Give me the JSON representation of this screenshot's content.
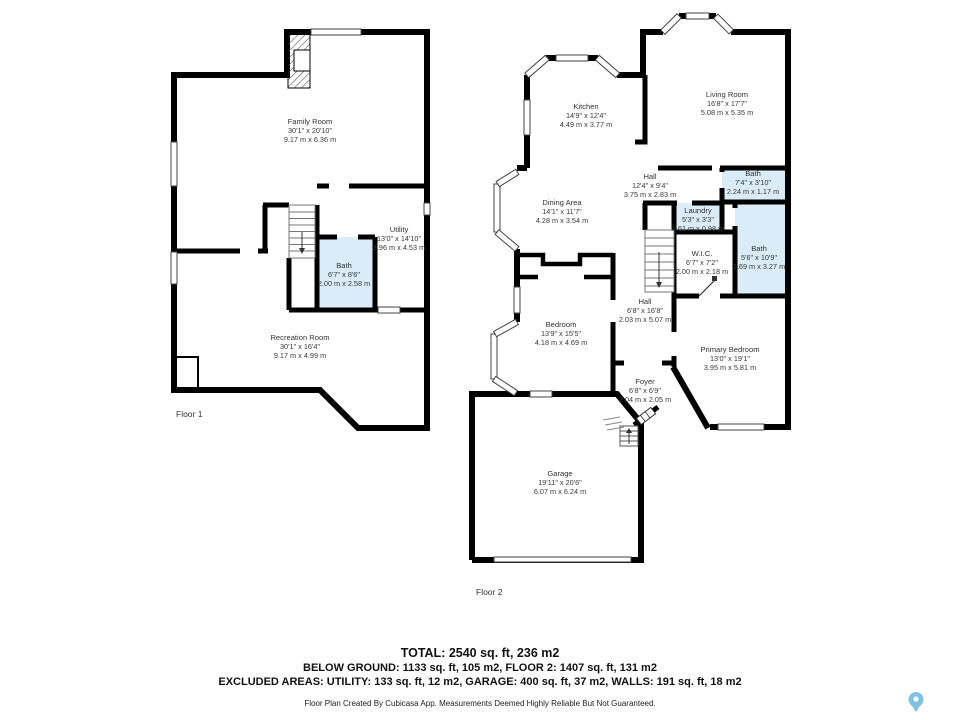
{
  "colors": {
    "wall": "#000000",
    "bath_fill": "#d9ecf8",
    "text": "#333333",
    "pin": "#7fc2e6"
  },
  "floor1": {
    "label": "Floor 1",
    "rooms": [
      {
        "name": "Family Room",
        "imperial": "30'1\" x 20'10\"",
        "metric": "9.17 m x 6.36 m"
      },
      {
        "name": "Utility",
        "imperial": "13'0\" x 14'10\"",
        "metric": "3.96 m x 4.53 m"
      },
      {
        "name": "Bath",
        "imperial": "6'7\" x 8'6\"",
        "metric": "2.00 m x 2.58 m"
      },
      {
        "name": "Recreation Room",
        "imperial": "30'1\" x 16'4\"",
        "metric": "9.17 m x 4.99 m"
      }
    ]
  },
  "floor2": {
    "label": "Floor 2",
    "rooms": [
      {
        "name": "Kitchen",
        "imperial": "14'9\" x 12'4\"",
        "metric": "4.49 m x 3.77 m"
      },
      {
        "name": "Living Room",
        "imperial": "16'8\" x 17'7\"",
        "metric": "5.08 m x 5.35 m"
      },
      {
        "name": "Dining Area",
        "imperial": "14'1\" x 11'7\"",
        "metric": "4.28 m x 3.54 m"
      },
      {
        "name": "Hall",
        "imperial": "12'4\" x 9'4\"",
        "metric": "3.75 m x 2.83 m"
      },
      {
        "name": "Bath",
        "imperial": "7'4\" x 3'10\"",
        "metric": "2.24 m x 1.17 m"
      },
      {
        "name": "Laundry",
        "imperial": "5'3\" x 3'3\"",
        "metric": "1.61 m x 0.98 m"
      },
      {
        "name": "W.I.C.",
        "imperial": "6'7\" x 7'2\"",
        "metric": "2.00 m x 2.18 m"
      },
      {
        "name": "Bath",
        "imperial": "5'6\" x 10'9\"",
        "metric": "1.69 m x 3.27 m"
      },
      {
        "name": "Hall",
        "imperial": "6'8\" x 16'8\"",
        "metric": "2.03 m x 5.07 m"
      },
      {
        "name": "Bedroom",
        "imperial": "13'9\" x 15'5\"",
        "metric": "4.18 m x 4.69 m"
      },
      {
        "name": "Primary Bedroom",
        "imperial": "13'0\" x 19'1\"",
        "metric": "3.95 m x 5.81 m"
      },
      {
        "name": "Foyer",
        "imperial": "6'8\" x 6'9\"",
        "metric": "2.04 m x 2.05 m"
      },
      {
        "name": "Garage",
        "imperial": "19'11\" x 20'6\"",
        "metric": "6.07 m x 6.24 m"
      }
    ]
  },
  "summary": {
    "total": "TOTAL: 2540 sq. ft, 236 m2",
    "line2": "BELOW GROUND: 1133 sq. ft, 105 m2, FLOOR 2: 1407 sq. ft, 131 m2",
    "line3": "EXCLUDED AREAS: UTILITY: 133 sq. ft, 12 m2, GARAGE: 400 sq. ft, 37 m2, WALLS: 191 sq. ft, 18 m2",
    "disclaimer": "Floor Plan Created By Cubicasa App. Measurements Deemed Highly Reliable But Not Guaranteed."
  }
}
